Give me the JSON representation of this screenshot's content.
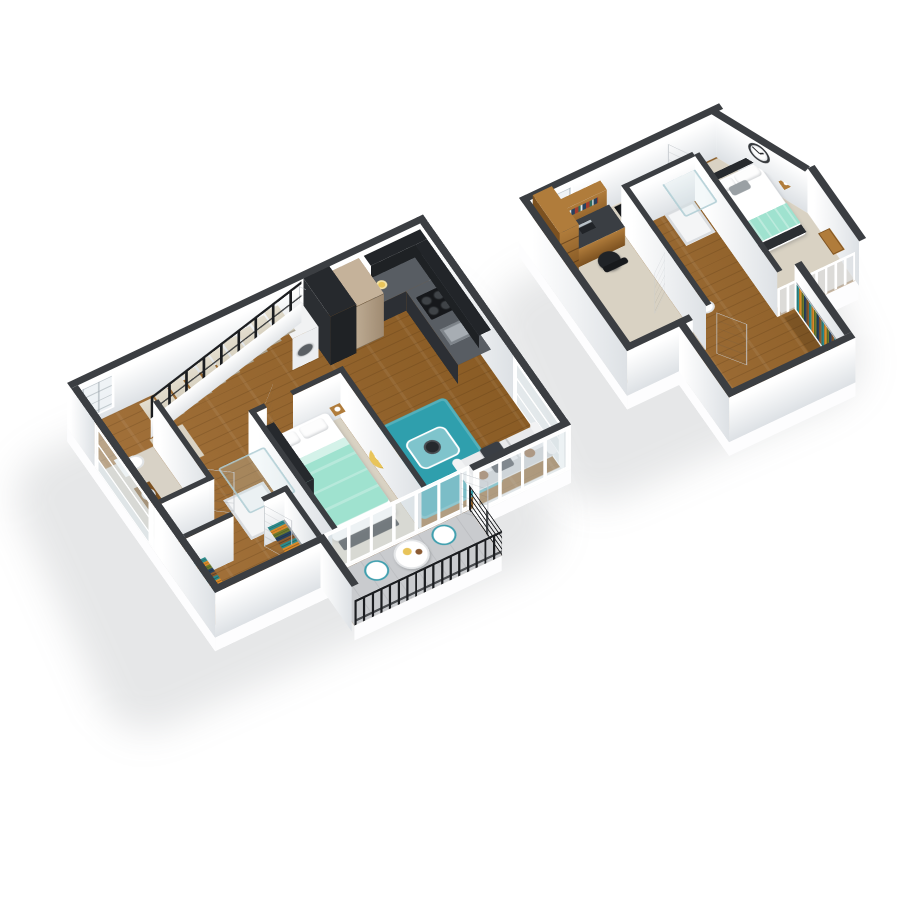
{
  "scene": {
    "background": "#ffffff",
    "floors": [
      {
        "name": "main-level",
        "rooms": [
          "kitchen",
          "living-room",
          "bedroom",
          "bathroom",
          "walk-in-closet",
          "staircase",
          "balcony",
          "hallway"
        ],
        "furnishings": [
          "black-stair-railing",
          "carpeted-steps",
          "refrigerator",
          "pantry-cabinet",
          "wall-cabinets",
          "range-cooktop",
          "kitchen-sink",
          "microwave",
          "food-plate",
          "washer",
          "sofa",
          "throw-blanket",
          "coffee-table",
          "teal-area-rug",
          "yellow-lounge-chair",
          "double-bed-mint-bedding",
          "foot-bench",
          "nightstand",
          "dark-wardrobe",
          "glass-shower",
          "toilet",
          "vanity-sink",
          "clothes-racks",
          "balcony-round-table",
          "balcony-chairs",
          "black-balcony-railing",
          "floor-to-ceiling-windows",
          "white-panel-doors"
        ]
      },
      {
        "name": "loft-level",
        "rooms": [
          "loft-bedroom",
          "office-nook",
          "bathroom",
          "walk-in-closet",
          "stairwell",
          "hallway"
        ],
        "furnishings": [
          "bookshelf",
          "desk-hutch",
          "laptop",
          "office-chair",
          "wall-clock",
          "double-bed-white-mint-bedding",
          "nightstand-lamp",
          "double-vanity-sinks",
          "toilet",
          "glass-shower",
          "hanging-clothes-rack",
          "shoe-rack",
          "white-loft-railing",
          "white-panel-doors"
        ]
      }
    ],
    "counts": {
      "stair_steps": 10,
      "balcony_chairs": 2,
      "vanity_sinks_loft": 2,
      "clothes_racks_main_closet": 2
    }
  },
  "colors": {
    "bg": "#ffffff",
    "wall_cap": "#3b3e42",
    "face_a": "#ffffff",
    "face_b": "#dde1e5",
    "wood_a": "#a2713a",
    "wood_b": "#8a5c25",
    "carpet": "#d9d2c3",
    "tile": "#d8d2c6",
    "concrete": "#c9cbce",
    "rug": "#2f9fad",
    "mint": "#9fe2cf",
    "dark": "#26292d",
    "dark_deep": "#1f2225",
    "counter_top": "#585d63",
    "counter_face": "#2c2f34",
    "cabinet": "#222529",
    "fridge_a": "#bcaa92",
    "fridge_b": "#a08b72",
    "yellow": "#e8c45a",
    "sofa": "#e9eaec",
    "sofa_dark": "#c8cacd",
    "glass_fill": "rgba(205,228,232,0.22)",
    "glass_edge": "rgba(175,205,212,0.85)",
    "rail_black": "#1b1d20",
    "door_face": "#f7f8f9",
    "wood_f_a": "#b07c3b",
    "wood_f_b": "#7c5120",
    "metal": "#9aa0a6",
    "pillow_brown": "#8a5a33",
    "pillow_gray": "#9aa0a4",
    "throw_dark": "#3a3e44",
    "win_frame": "#ffffff",
    "win_glass": "rgba(214,226,230,0.45)",
    "cl1": "#2e8b8b",
    "cl2": "#d98a2b",
    "cl3": "#6b7a2d",
    "cl4": "#27415e",
    "cl5": "#8a5a2f",
    "shadow": "rgba(99,104,110,0.16)"
  }
}
